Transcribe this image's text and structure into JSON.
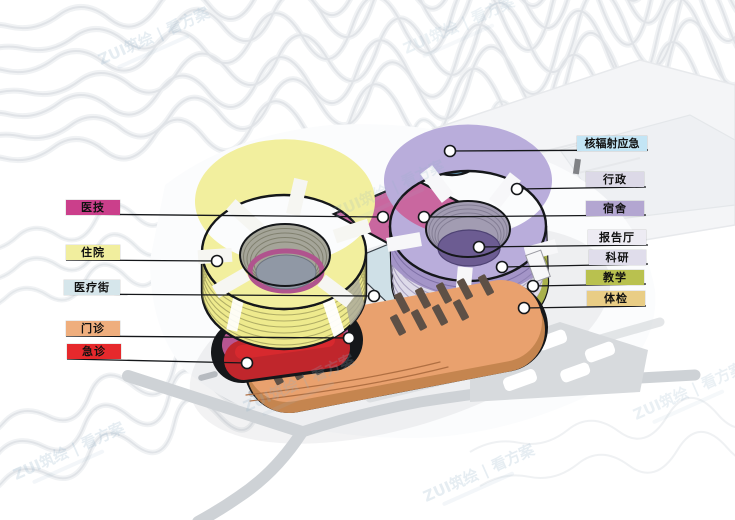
{
  "watermark": {
    "text": "ZUI筑绘 | 看方案"
  },
  "labels": {
    "left": [
      {
        "label": "医技",
        "bg": "#cb3f8b",
        "zone": "medical-tech"
      },
      {
        "label": "住院",
        "bg": "#f1ee9e",
        "zone": "inpatient"
      },
      {
        "label": "医疗街",
        "bg": "#d6e6eb",
        "zone": "medical-street"
      },
      {
        "label": "门诊",
        "bg": "#efae7d",
        "zone": "outpatient"
      },
      {
        "label": "急诊",
        "bg": "#e6292c",
        "zone": "emergency"
      }
    ],
    "right": [
      {
        "label": "核辐射应急",
        "bg": "#c3e5f5",
        "zone": "nuclear-radiation-emergency"
      },
      {
        "label": "行政",
        "bg": "#dcd9e7",
        "zone": "administration"
      },
      {
        "label": "宿舍",
        "bg": "#b3a6d1",
        "zone": "dormitory"
      },
      {
        "label": "报告厅",
        "bg": "#edebf3",
        "zone": "lecture-hall"
      },
      {
        "label": "科研",
        "bg": "#e0ddeb",
        "zone": "research"
      },
      {
        "label": "教学",
        "bg": "#b9c14f",
        "zone": "teaching"
      },
      {
        "label": "体检",
        "bg": "#e9cd85",
        "zone": "physical-exam"
      }
    ]
  },
  "zone_colors": {
    "inpatient_ring": "#f2ef9e",
    "dormitory_ring": "#b9addb",
    "research_floors": "#dedbe9",
    "teaching_band": "#a9b14c",
    "outpatient_slab": "#e9a16e",
    "emergency_band": "#c0262c",
    "medical_tech_slab": "#c9679f",
    "medical_street_deck": "#cfe0e7",
    "nuclear_cylinder": "#a7daf3",
    "lecture_hall_disc": "#6c5c92"
  }
}
